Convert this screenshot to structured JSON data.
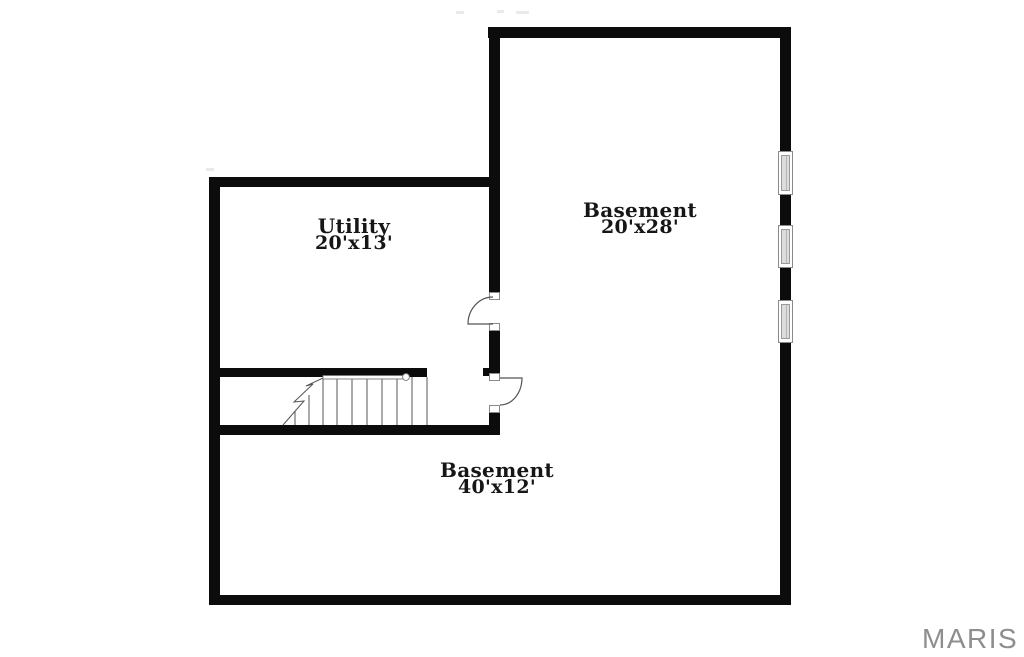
{
  "page": {
    "background": "#ffffff",
    "kind": "basement-floor-plan"
  },
  "plan": {
    "wall_color": "#0c0c0c",
    "thin_line_color": "#555555",
    "rooms": [
      {
        "name": "Utility",
        "dims": "20'x13'"
      },
      {
        "name": "Basement",
        "dims": "20'x28'"
      },
      {
        "name": "Basement",
        "dims": "40'x12'"
      }
    ],
    "symbols": {
      "windows": 3,
      "door_swings": 2,
      "staircases": 1
    }
  },
  "watermark": {
    "text": "MARIS",
    "color": "#8d8e90"
  }
}
